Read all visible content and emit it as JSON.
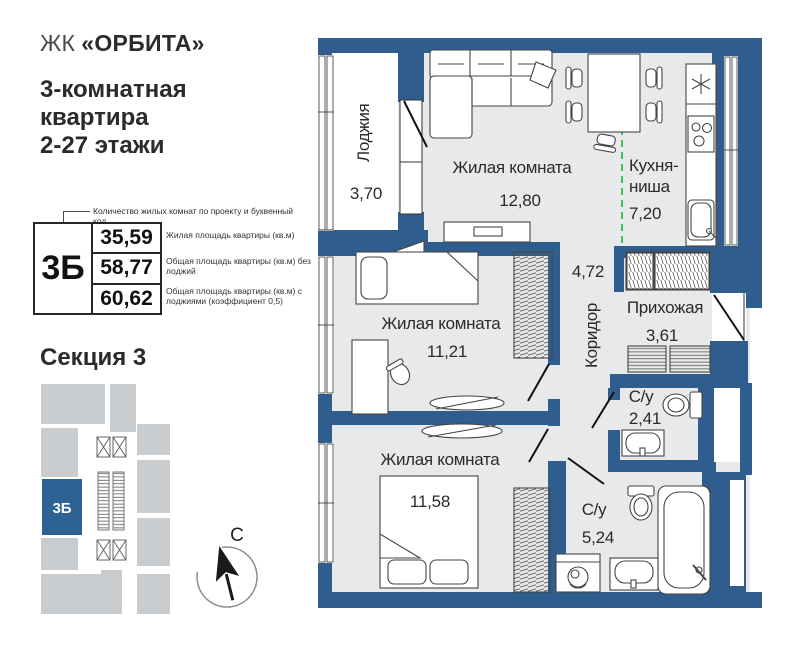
{
  "header": {
    "complex_prefix": "ЖК",
    "complex_name": "«ОРБИТА»",
    "title_line1": "3-комнатная",
    "title_line2": "квартира",
    "title_line3": "2-27 этажи"
  },
  "legend": {
    "note": "Количество жилых комнат по проекту и буквенный код",
    "code": "3Б",
    "rows": [
      {
        "value": "35,59",
        "label": "Жилая площадь квартиры (кв.м)"
      },
      {
        "value": "58,77",
        "label": "Общая площадь квартиры (кв.м) без лоджий"
      },
      {
        "value": "60,62",
        "label": "Общая площадь квартиры (кв.м) с лоджиями (коэффициент 0,5)"
      }
    ]
  },
  "section": {
    "title": "Секция 3",
    "highlight": "3Б"
  },
  "compass": {
    "north": "С"
  },
  "plan": {
    "loggia": {
      "name": "Лоджия",
      "area": "3,70"
    },
    "living_top": {
      "name": "Жилая комната",
      "area": "12,80"
    },
    "kitchen": {
      "name1": "Кухня-",
      "name2": "ниша",
      "area": "7,20"
    },
    "corridor": {
      "name": "Коридор",
      "area": "4,72"
    },
    "hall": {
      "name": "Прихожая",
      "area": "3,61"
    },
    "bath_small": {
      "name": "С/у",
      "area": "2,41"
    },
    "living_mid": {
      "name": "Жилая комната",
      "area": "11,21"
    },
    "living_bottom": {
      "name": "Жилая комната",
      "area": "11,58"
    },
    "bath_big": {
      "name": "С/у",
      "area": "5,24"
    }
  },
  "colors": {
    "wall": "#2f5e8e",
    "floor": "#e8e9ea",
    "mini_gray": "#c9cdd0",
    "accent_blue": "#2d6295",
    "green_line": "#44c063"
  }
}
